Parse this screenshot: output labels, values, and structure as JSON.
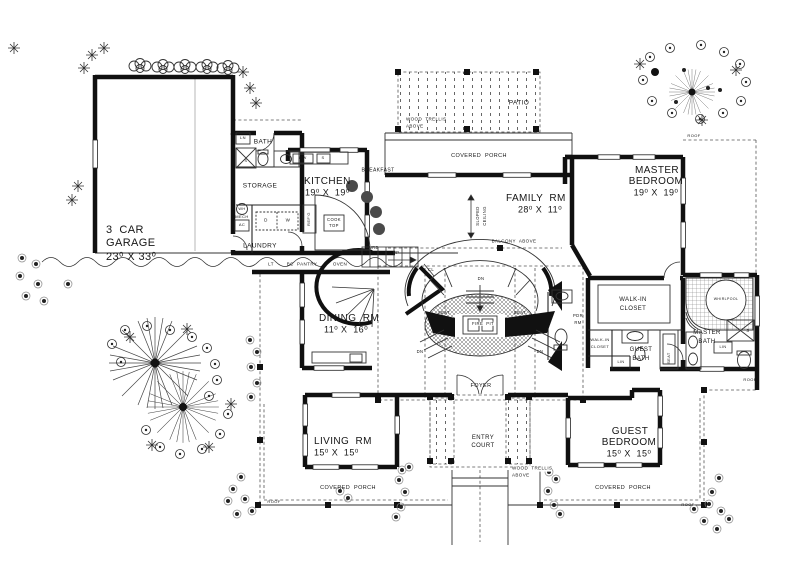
{
  "plan": {
    "title": "First floor plan",
    "rooms": {
      "garage": {
        "line1": "3  CAR",
        "line2": "GARAGE",
        "dims": "23⁰ X 33⁰"
      },
      "kitchen": {
        "name": "KITCHEN",
        "dims": "19⁰ X  19⁰"
      },
      "family": {
        "name": "FAMILY  RM",
        "dims": "28⁰ X  11⁰"
      },
      "master_bedroom": {
        "line1": "MASTER",
        "line2": "BEDROOM",
        "dims": "19⁰ X  19⁰"
      },
      "dining": {
        "name": "DINING  RM",
        "dims": "11⁰ X  16⁰"
      },
      "living": {
        "name": "LIVING  RM",
        "dims": "15⁰ X  15⁰"
      },
      "guest_bedroom": {
        "line1": "GUEST",
        "line2": "BEDROOM",
        "dims": "15⁰ X  15⁰"
      },
      "bath": "BATH",
      "storage": "STORAGE",
      "laundry": "LAUNDRY",
      "breakfast": "BREAKFAST",
      "foyer": "FOYER",
      "fire_pit": "FIRE  PIT",
      "entry_court": {
        "line1": "ENTRY",
        "line2": "COURT"
      },
      "pdr": {
        "line1": "PDR",
        "line2": "RM"
      },
      "walkin_large": {
        "line1": "WALK-IN",
        "line2": "CLOSET"
      },
      "walkin_small": {
        "line1": "WALK-IN",
        "line2": "CLOSET"
      },
      "guest_bath": {
        "line1": "GUEST",
        "line2": "BATH"
      },
      "master_bath": {
        "line1": "MASTER",
        "line2": "BATH"
      },
      "patio": "PATIO"
    },
    "areas": {
      "covered_porch": "COVERED  PORCH",
      "balcony_above": "BALCONY  ABOVE",
      "wood_trellis": {
        "line1": "WOOD  TRELLIS",
        "line2": "ABOVE"
      },
      "sloped": "SLOPED",
      "ceiling": "CEILING",
      "curb": "CURB",
      "roof": "ROOF"
    },
    "fixtures": {
      "cook_top": {
        "line1": "COOK",
        "line2": "TOP"
      },
      "whirlpool": "WHIRLPOOL",
      "dw": "DW",
      "s": "S",
      "refg": "REF'G",
      "wh": "WH",
      "mech": "MECH",
      "ac": "AC",
      "d": "D",
      "w": "W",
      "lt": "LT",
      "bc_pantry": "BC  PANTRY",
      "oven": "OVEN",
      "ln": "LN",
      "lin": "LIN",
      "seat": "SEAT",
      "up": "UP",
      "dn": "DN",
      "cl": "CL"
    },
    "colors": {
      "ink": "#141414",
      "paper": "#ffffff"
    }
  }
}
